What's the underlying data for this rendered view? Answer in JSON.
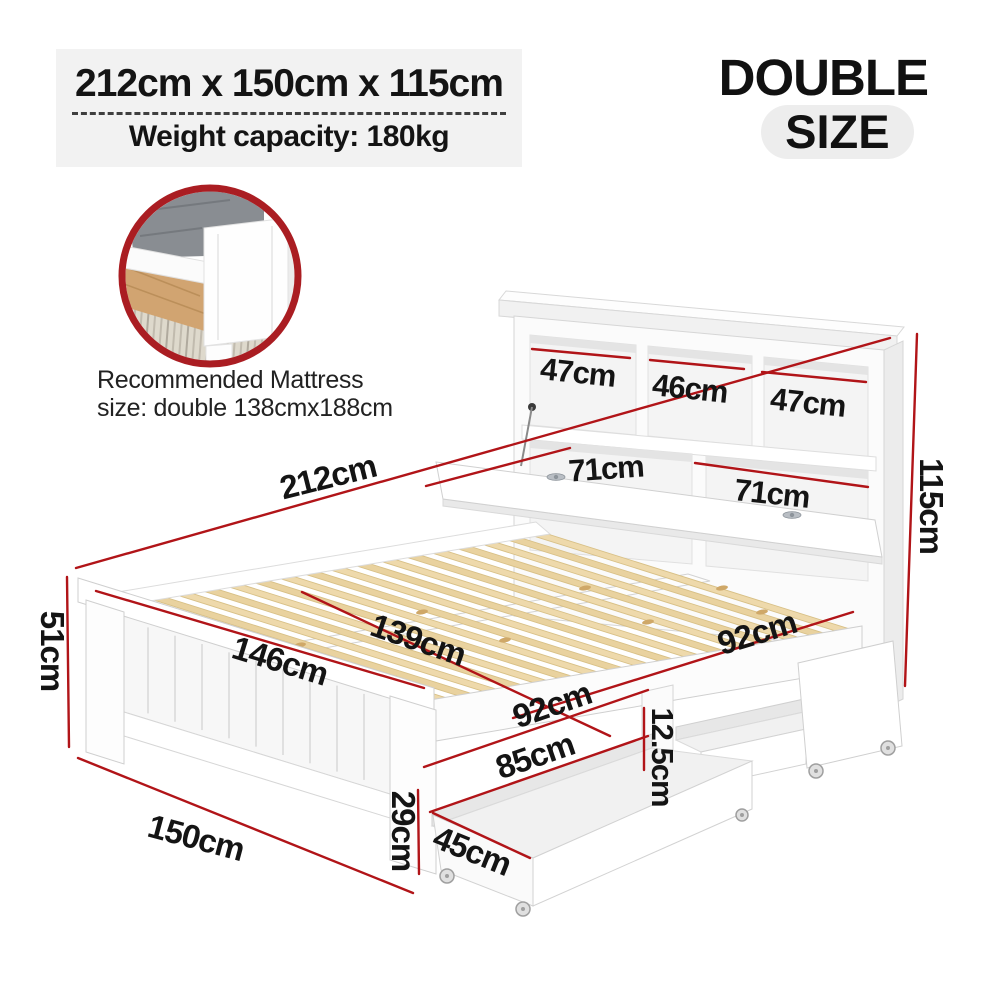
{
  "header": {
    "dimensions_title": "212cm x 150cm x 115cm",
    "weight_capacity": "Weight capacity: 180kg"
  },
  "size_badge": {
    "line1": "DOUBLE",
    "line2": "SIZE"
  },
  "inset": {
    "caption_line1": "Recommended Mattress",
    "caption_line2": "size: double 138cmx188cm"
  },
  "diagram": {
    "labels": {
      "shelf_left": "47cm",
      "shelf_center": "46cm",
      "shelf_right": "47cm",
      "compartment_left": "71cm",
      "compartment_right": "71cm",
      "bed_length": "212cm",
      "headboard_height": "115cm",
      "footboard_height": "51cm",
      "footboard_top_width": "146cm",
      "slat_width": "139cm",
      "rail_segment_front": "92cm",
      "rail_segment_back": "92cm",
      "drawer_length": "85cm",
      "drawer_gap_height": "12.5cm",
      "drawer_width": "45cm",
      "leg_height": "29cm",
      "bed_base_width": "150cm"
    }
  },
  "colors": {
    "accent_red": "#b11418",
    "ring_red": "#aa1d22",
    "text_black": "#141414",
    "panel_gray": "#f2f2f2",
    "slat_wood": "#ecd7a7"
  }
}
